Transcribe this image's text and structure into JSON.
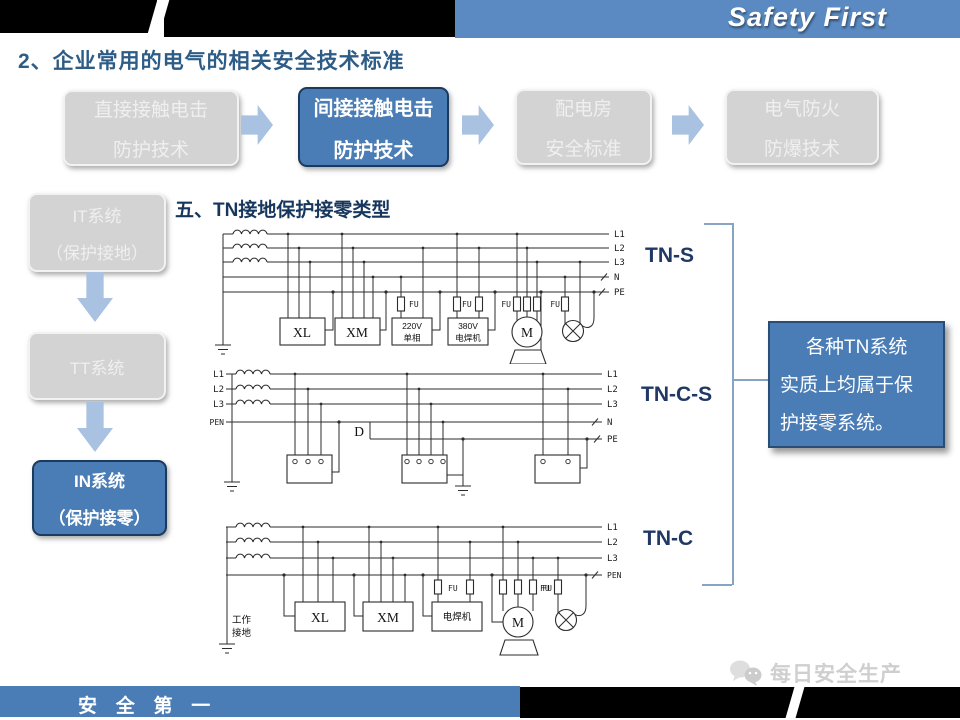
{
  "colors": {
    "header_bar_blue": "#5a8ac1",
    "accent_blue": "#4a7cb5",
    "inactive_gray": "#d3d3d3",
    "title_text_blue": "#2d5c86",
    "heading_navy": "#17365d",
    "tn_label_navy": "#1f3864",
    "arrow_light_blue": "#a9c2e1"
  },
  "header": {
    "brand": "Safety First",
    "title": "2、企业常用的电气的相关安全技术标准"
  },
  "top_flow": [
    {
      "line1": "直接接触电击",
      "line2": "防护技术"
    },
    {
      "line1": "间接接触电击",
      "line2": "防护技术"
    },
    {
      "line1": "配电房",
      "line2": "安全标准"
    },
    {
      "line1": "电气防火",
      "line2": "防爆技术"
    }
  ],
  "left_flow": [
    {
      "line1": "IT系统",
      "line2": "（保护接地）"
    },
    {
      "line1": "TT系统",
      "line2": ""
    },
    {
      "line1": "IN系统",
      "line2": "（保护接零）"
    }
  ],
  "section_heading": "五、TN接地保护接零类型",
  "diagram_tns": {
    "label": "TN-S",
    "bus": [
      "L1",
      "L2",
      "L3",
      "N",
      "PE"
    ],
    "xl": "XL",
    "xm": "XM",
    "b220_1": "220V",
    "b220_2": "单相",
    "b380_1": "380V",
    "b380_2": "电焊机",
    "motor": "M",
    "fu": "FU"
  },
  "diagram_tncs": {
    "label": "TN-C-S",
    "left_bus": [
      "L1",
      "L2",
      "L3",
      "PEN"
    ],
    "right_bus": [
      "L1",
      "L2",
      "L3",
      "N",
      "PE"
    ],
    "split": "D"
  },
  "diagram_tnc": {
    "label": "TN-C",
    "bus": [
      "L1",
      "L2",
      "L3",
      "PEN"
    ],
    "xl": "XL",
    "xm": "XM",
    "welder": "电焊机",
    "motor": "M",
    "fu": "FU",
    "ground1": "工作",
    "ground2": "接地"
  },
  "note_lines": [
    "各种TN系统",
    "实质上均属于保",
    "护接零系统。"
  ],
  "footer": {
    "slogan": "安 全 第 一",
    "watermark": "每日安全生产"
  }
}
